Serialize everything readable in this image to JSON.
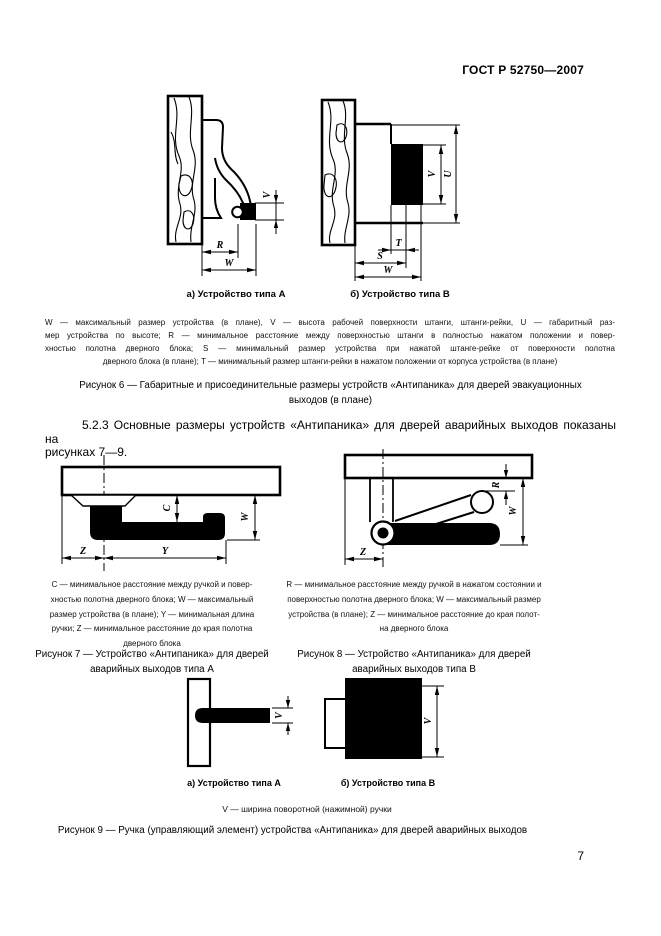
{
  "header": {
    "doc_code": "ГОСТ Р 52750—2007"
  },
  "fig6": {
    "caption_a": "а) Устройство типа А",
    "caption_b": "б) Устройство типа В",
    "dim_labels": {
      "V": "V",
      "U": "U",
      "R": "R",
      "W": "W",
      "S": "S",
      "T": "T"
    },
    "legend_lines": [
      "W — максимальный размер устройства (в плане), V — высота рабочей поверхности штанги, штанги-рейки, U — габаритный раз-",
      "мер устройства по высоте; R — минимальное расстояние между поверхностью штанги в полностью нажатом положении и повер-",
      "хностью полотна дверного блока; S — минимальный размер устройства при нажатой штанге-рейке от поверхности полотна",
      "дверного блока (в плане); T — минимальный размер штанги-рейки в нажатом положении от корпуса устройства (в плане)"
    ],
    "caption_lines": [
      "Рисунок 6 — Габаритные и присоединительные размеры устройств «Антипаника» для дверей эвакуационных",
      "выходов (в плане)"
    ]
  },
  "section_5_2_3": {
    "line1": "5.2.3 Основные размеры устройств «Антипаника» для дверей аварийных выходов показаны на",
    "line2": "рисунках 7—9."
  },
  "fig7": {
    "dim_labels": {
      "C": "C",
      "W": "W",
      "Y": "Y",
      "Z": "Z"
    },
    "legend_lines": [
      "C — минимальное расстояние между ручкой и повер-",
      "хностью полотна дверного блока; W — максимальный",
      "размер устройства (в плане); Y — минимальная длина",
      "ручки; Z — минимальное расстояние до края полотна",
      "дверного блока"
    ],
    "caption_lines": [
      "Рисунок 7 — Устройство «Антипаника» для дверей",
      "аварийных выходов типа А"
    ]
  },
  "fig8": {
    "dim_labels": {
      "R": "R",
      "W": "W",
      "Z": "Z"
    },
    "legend_lines": [
      "R — минимальное расстояние между ручкой в нажатом состоянии и",
      "поверхностью полотна дверного блока; W — максимальный размер",
      "устройства (в плане); Z — минимальное расстояние до края полот-",
      "на дверного блока"
    ],
    "caption_lines": [
      "Рисунок 8 — Устройство «Антипаника» для дверей",
      "аварийных выходов типа В"
    ]
  },
  "fig9": {
    "caption_a": "а) Устройство типа А",
    "caption_b": "б) Устройство типа В",
    "dim_labels": {
      "V": "V"
    },
    "legend": "V — ширина поворотной (нажимной) ручки",
    "caption": "Рисунок 9 — Ручка (управляющий элемент) устройства «Антипаника» для дверей аварийных выходов"
  },
  "footer": {
    "page_number": "7"
  }
}
